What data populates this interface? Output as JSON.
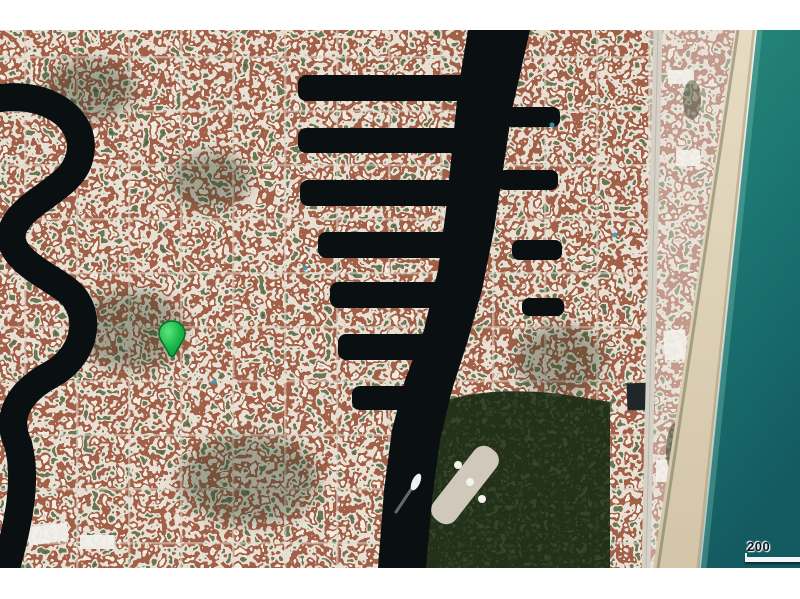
{
  "page": {
    "background_color": "#ffffff"
  },
  "map": {
    "description": "Aerial satellite view of a coastal canal-front residential neighborhood with Intracoastal waterway, beach and ocean",
    "marker": {
      "name": "property-location",
      "color": "#1ec853"
    },
    "scale_bar": {
      "label": "200"
    },
    "attribution": "© 2019 Microsoft Corporation - Bing",
    "colors": {
      "canal_water": "#0a0f11",
      "ocean_top": "#26897c",
      "ocean_bottom": "#135a60",
      "beach_sand": "#ddd0b6",
      "residential_light": "#efede6",
      "residential_terracotta": "#a2573f",
      "vegetation_dark": "#2c3823",
      "road": "#d5d0c5"
    }
  }
}
